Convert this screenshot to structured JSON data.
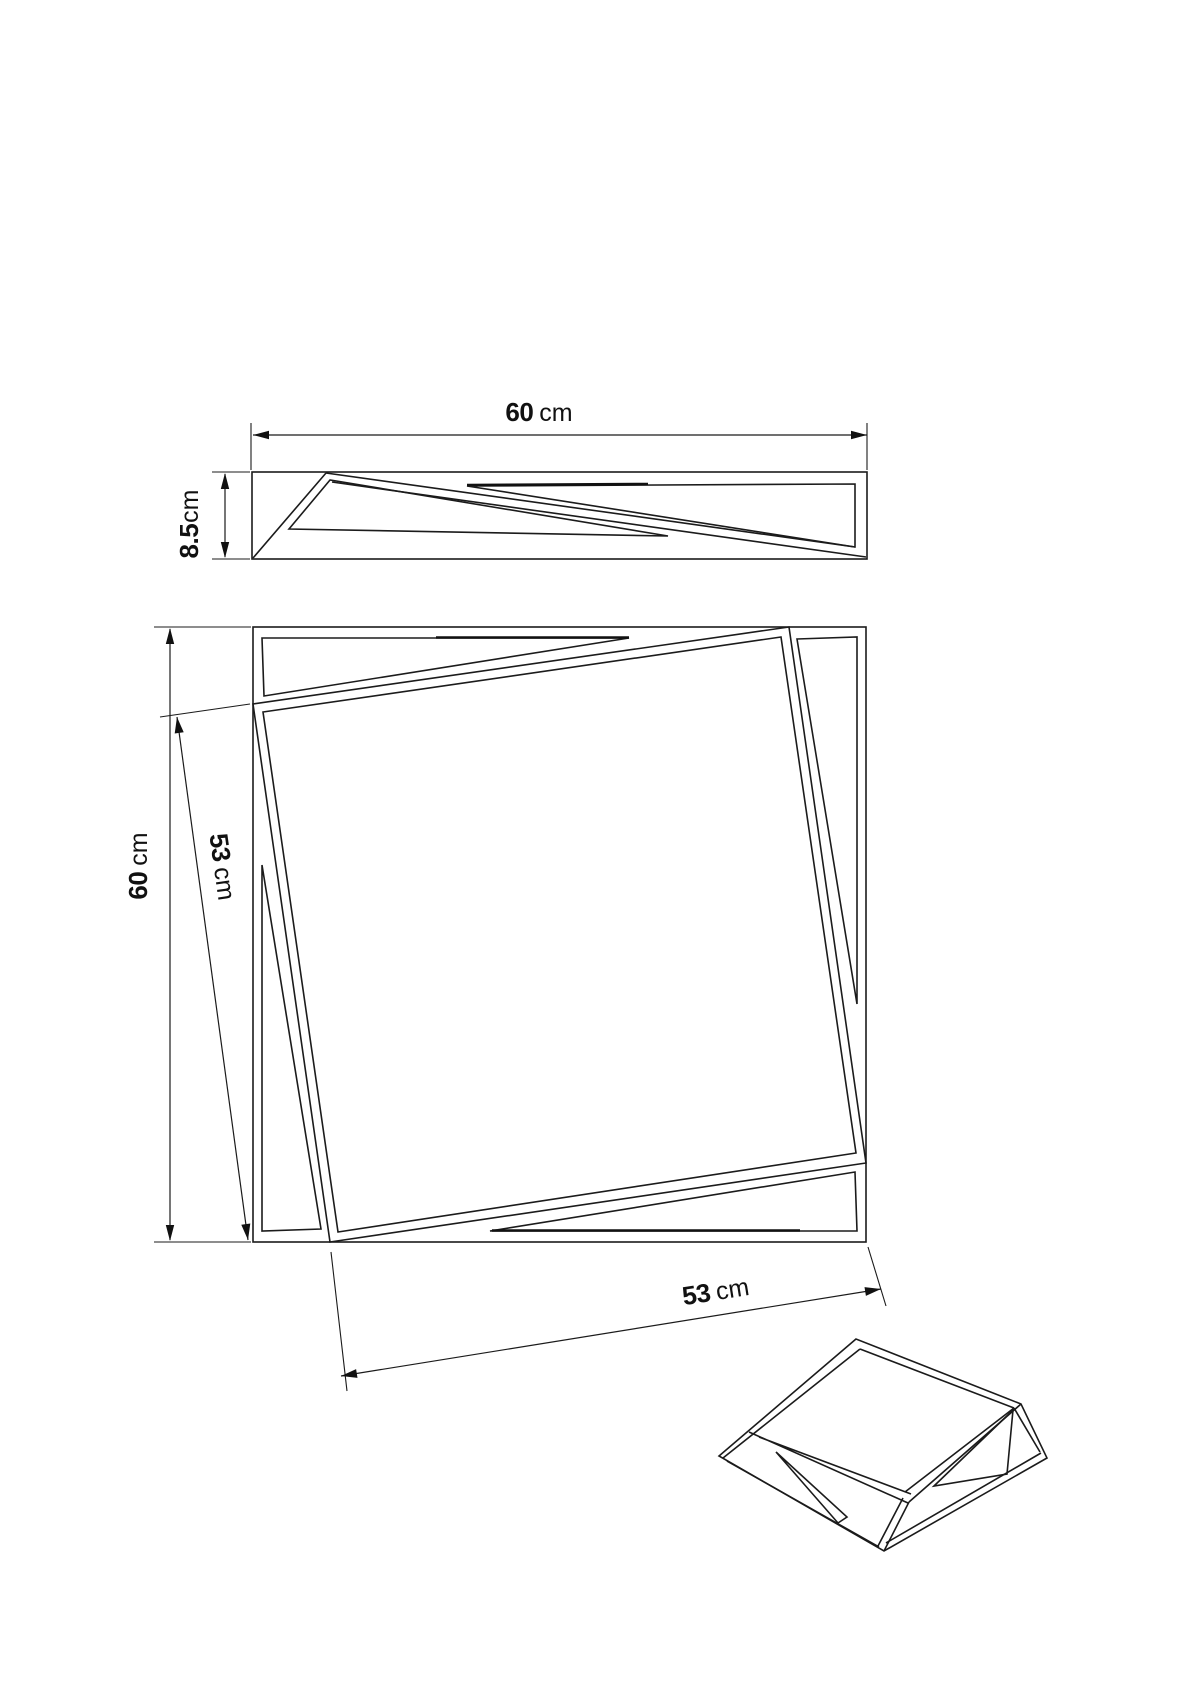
{
  "page": {
    "background": "#ffffff",
    "line_color": "#1b1b1b",
    "description": "Technical dimension drawing of a square wall mirror with rotated inner frame"
  },
  "views": {
    "side_view": {
      "label": "side-profile-view",
      "width_dim": {
        "value": "60",
        "unit": "cm"
      },
      "depth_dim": {
        "value": "8.5",
        "unit": "cm"
      }
    },
    "front_view": {
      "label": "front-view",
      "height_dim": {
        "value": "60",
        "unit": "cm"
      },
      "inner_side_dim": {
        "value": "53",
        "unit": "cm"
      },
      "inner_bottom_dim": {
        "value": "53",
        "unit": "cm"
      }
    },
    "perspective_view": {
      "label": "perspective-view"
    }
  }
}
